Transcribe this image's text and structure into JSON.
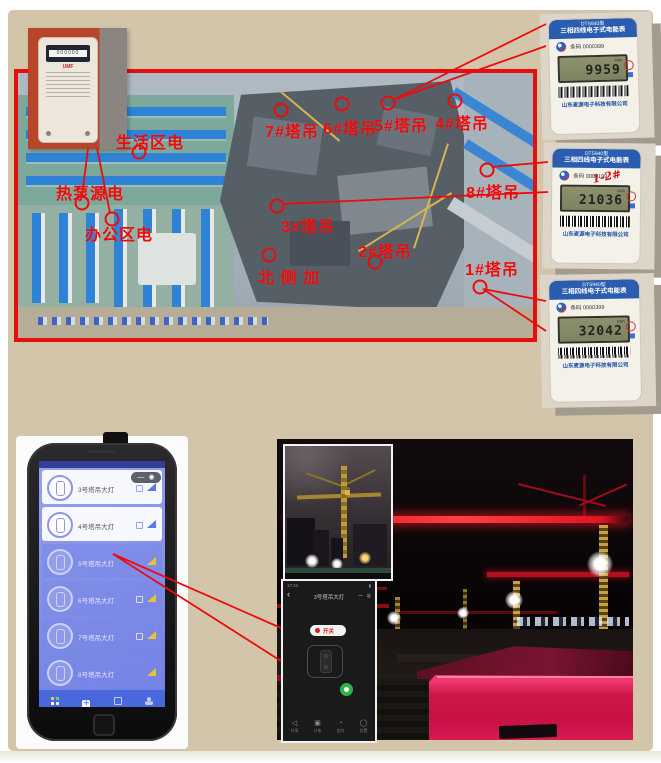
{
  "annotations": {
    "color": "#ee0a0a",
    "site_labels": [
      {
        "text": "生活区电"
      },
      {
        "text": "热泵源电"
      },
      {
        "text": "办公区电"
      },
      {
        "text": "7#塔吊"
      },
      {
        "text": "6#塔吊"
      },
      {
        "text": "5#塔吊"
      },
      {
        "text": "4#塔吊"
      },
      {
        "text": "8#塔吊"
      },
      {
        "text": "3#塔吊"
      },
      {
        "text": "2#塔吊"
      },
      {
        "text": "1#塔吊"
      },
      {
        "text": "北 侧 加"
      }
    ]
  },
  "meters": {
    "header_model": "DTS940型",
    "header_type": "三相四线电子式电能表",
    "company": "山东麦源电子科技有限公司",
    "unit": "kWh",
    "tl_brand": "UMF",
    "tl_digits": "000000",
    "items": [
      {
        "serial": "条码 0000399",
        "reading": "9959",
        "note": ""
      },
      {
        "serial": "条码 0000199",
        "reading": "21036",
        "note": "1-2#"
      },
      {
        "serial": "条码 0000399",
        "reading": "32042",
        "note": ""
      }
    ]
  },
  "phone": {
    "cards": [
      {
        "label": "3号塔吊大灯"
      },
      {
        "label": "4号塔吊大灯"
      },
      {
        "label": "5号塔吊大灯"
      },
      {
        "label": "6号塔吊大灯"
      },
      {
        "label": "7号塔吊大灯"
      },
      {
        "label": "8号塔吊大灯"
      }
    ],
    "tabs": [
      {
        "label": "设备列表"
      },
      {
        "label": "添加设备"
      },
      {
        "label": "生活用电"
      },
      {
        "label": "用户中心"
      }
    ]
  },
  "remote": {
    "status_time": "17:41",
    "title": "3号塔吊大灯",
    "power_label": "开关",
    "toolbar": [
      {
        "label": "共享"
      },
      {
        "label": "计电"
      },
      {
        "label": "定时"
      },
      {
        "label": "设置"
      }
    ]
  },
  "icons": {
    "back": "‹",
    "minimize": "—",
    "close": "◉",
    "more": "◎",
    "battery": "▮",
    "plus": "＋",
    "share": "◁",
    "meter": "▣",
    "timer": "◔",
    "settings": "◯"
  }
}
